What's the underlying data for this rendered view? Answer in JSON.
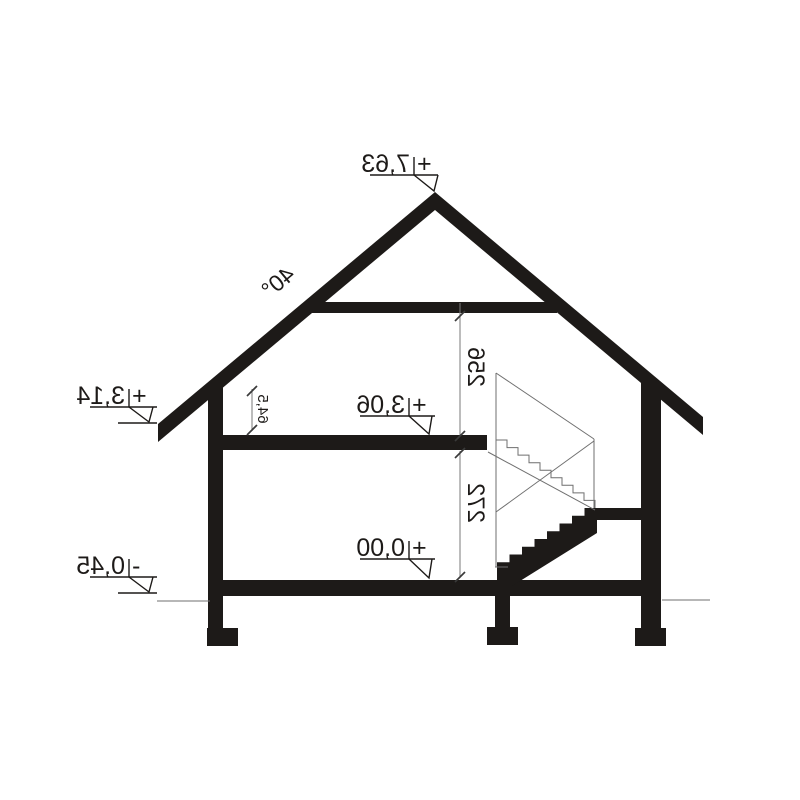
{
  "drawing": {
    "title": "house-cross-section",
    "background": "#ffffff",
    "ink": "#1d1a18",
    "roof": {
      "angle_label": "40°"
    },
    "dimensions": {
      "attic_clear_height": "256",
      "ground_floor_clear_height": "272",
      "knee_wall_height": "64,5"
    },
    "levels": {
      "ridge": {
        "sign": "+",
        "value": "7,63"
      },
      "eaves": {
        "sign": "+",
        "value": "3,14"
      },
      "attic_floor": {
        "sign": "+",
        "value": "3,06"
      },
      "ground_floor": {
        "sign": "+",
        "value": "0,00"
      },
      "terrain": {
        "sign": "-",
        "value": "0,45"
      }
    }
  }
}
